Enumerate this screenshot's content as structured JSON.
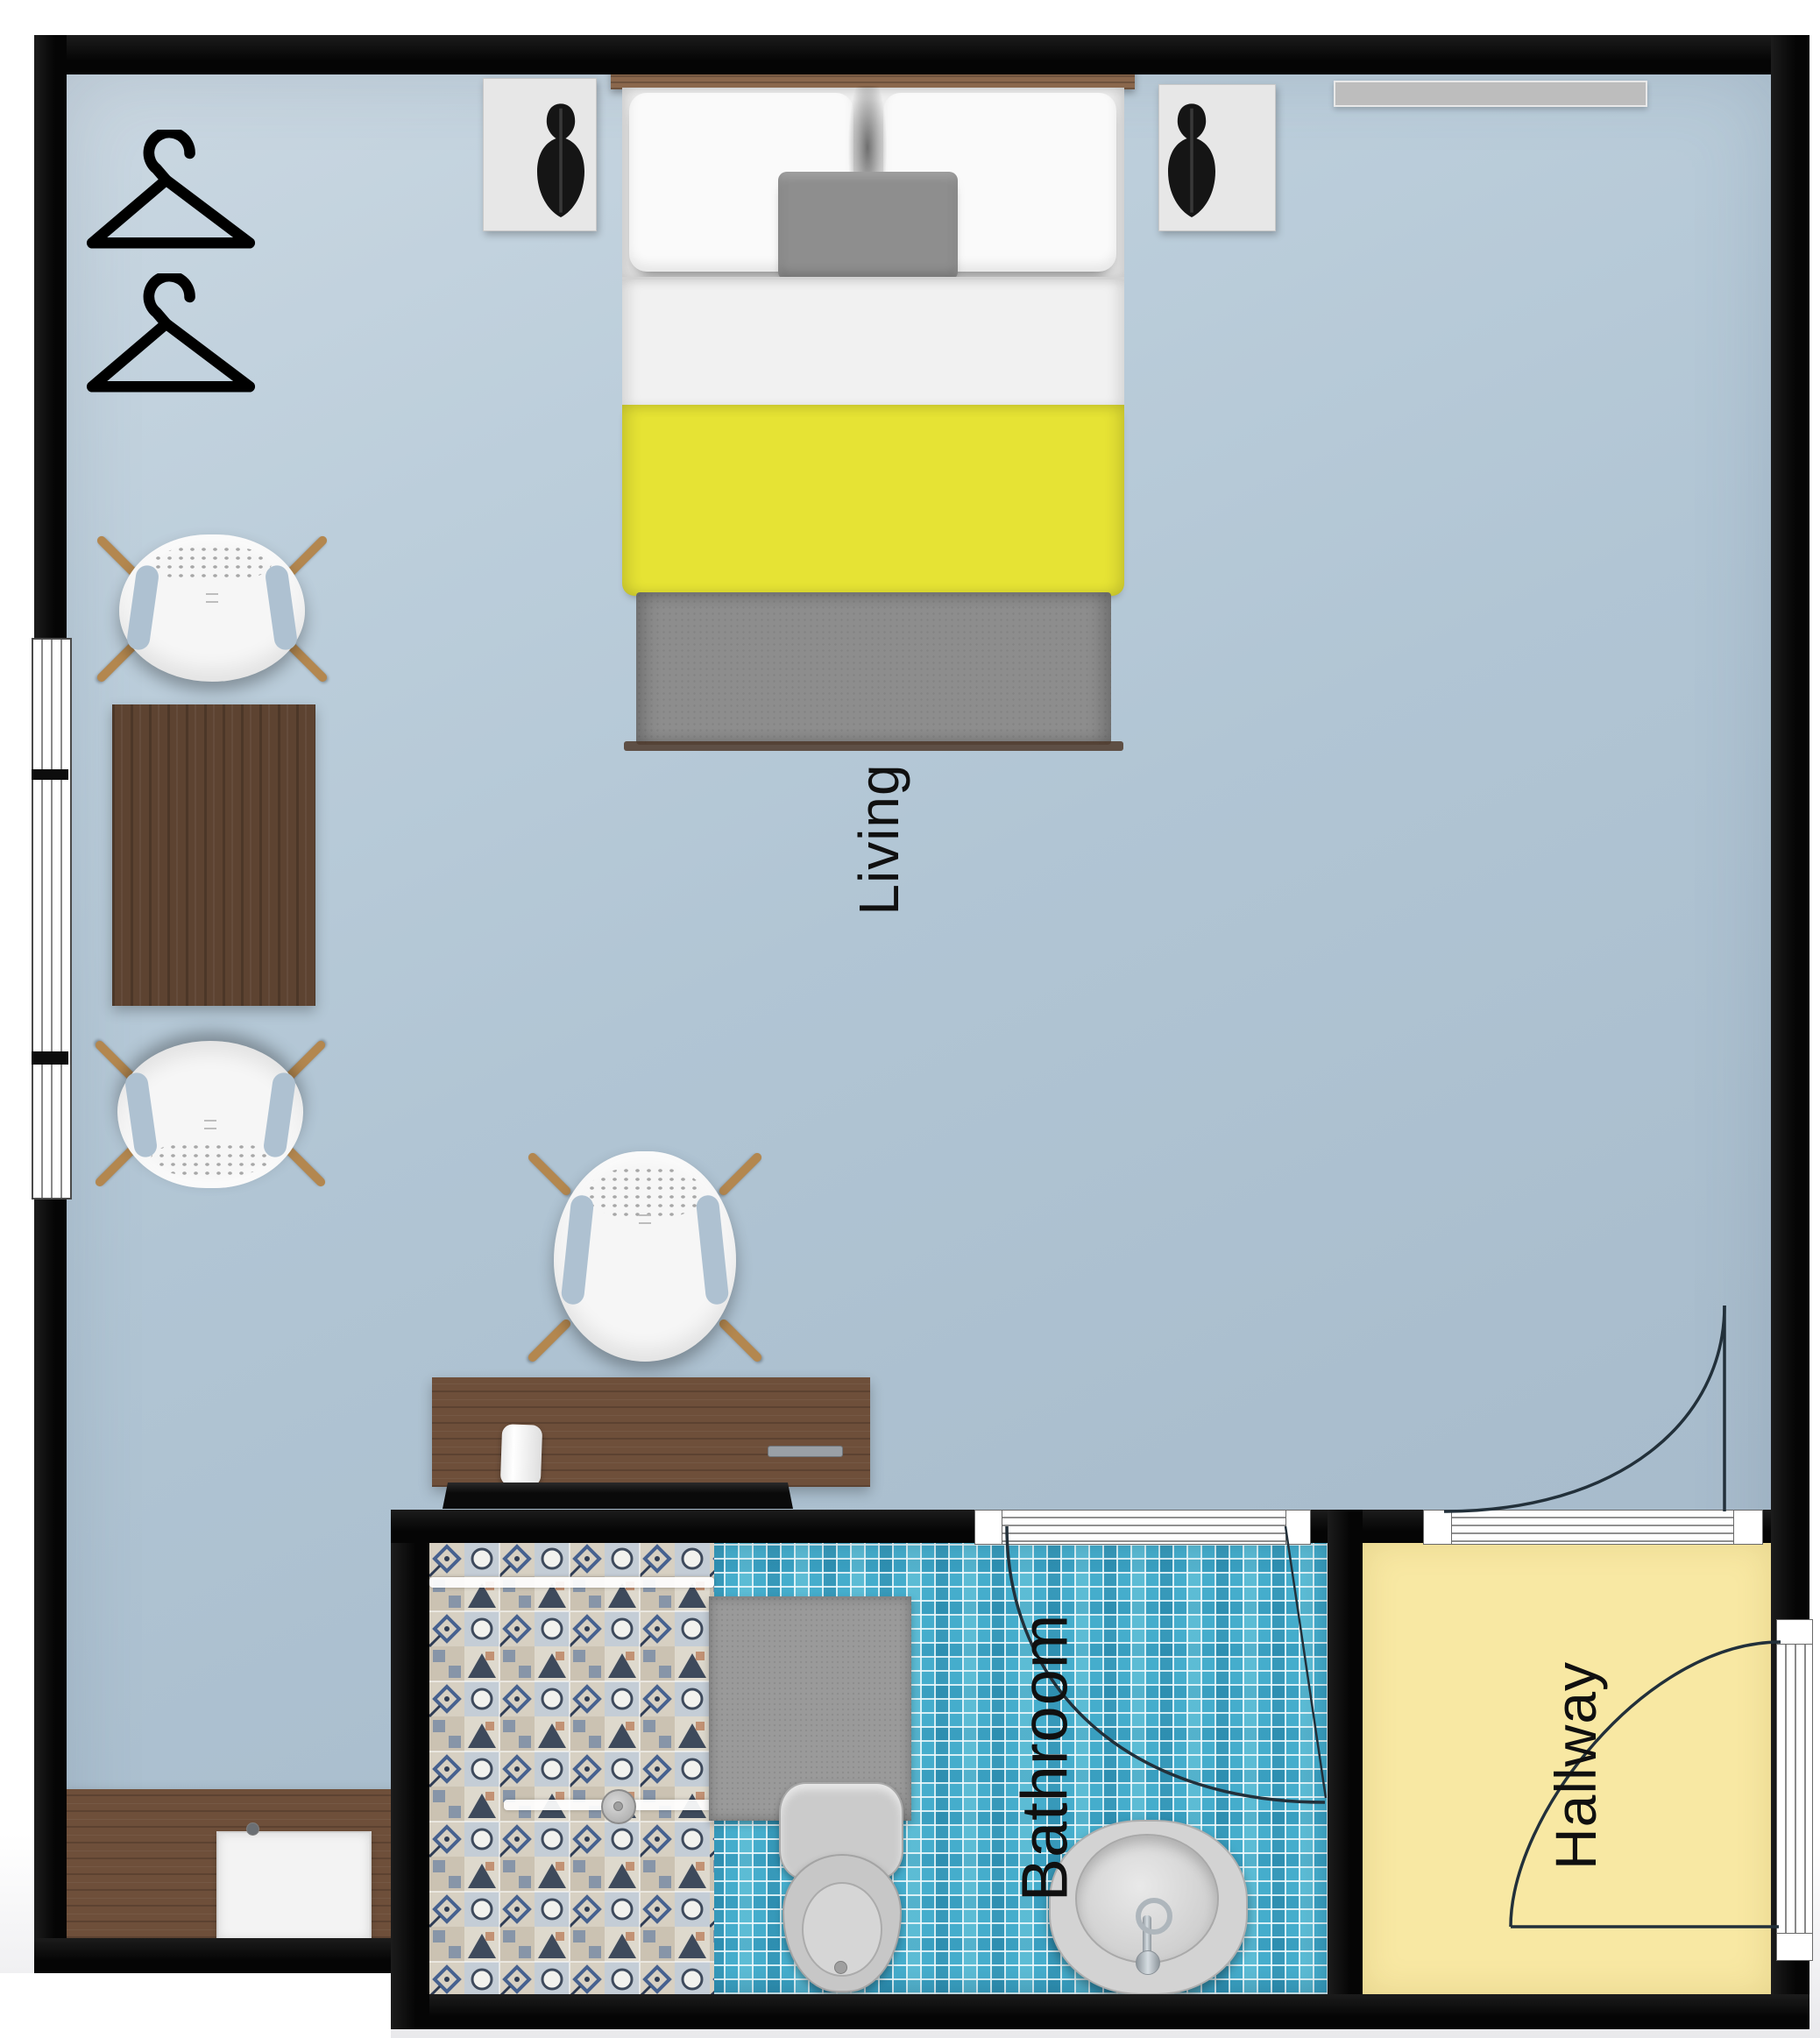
{
  "plan": {
    "type": "apartment-floorplan",
    "rooms": [
      {
        "name": "living",
        "label": "Living"
      },
      {
        "name": "bathroom",
        "label": "Bathroom"
      },
      {
        "name": "hallway",
        "label": "Hallway"
      }
    ],
    "furniture": [
      "double-bed",
      "pillows",
      "gray-accent-pillow",
      "yellow-bed-runner",
      "gray-blanket",
      "nightstand-left",
      "nightstand-right",
      "table-lamp-left",
      "table-lamp-right",
      "coat-hanger-1",
      "coat-hanger-2",
      "wall-shelf",
      "armchair-top-left",
      "armchair-mid-left",
      "armchair-center",
      "side-table",
      "desk",
      "rolled-towel",
      "drawer-handle",
      "tv",
      "vanity-counter",
      "vanity-sink",
      "faucet-dot",
      "shower",
      "shower-glass",
      "shower-head",
      "bath-mat",
      "toilet",
      "washbasin",
      "basin-faucet"
    ],
    "doors": [
      "bathroom-door",
      "living-hallway-door",
      "entrance-door"
    ],
    "windows": [
      "left-wall-window-1",
      "left-wall-window-2",
      "left-wall-window-3",
      "bathroom-doorway-threshold",
      "hallway-doorway-threshold",
      "entrance-doorway"
    ],
    "colors": {
      "wall": "#0a0a0a",
      "floor_living": "#b1c5d4",
      "floor_hallway": "#f8e8a3",
      "floor_bathroom_tile": "#45adcc",
      "shower_tile_base": "#d7d0c2",
      "bed_accent_yellow": "#e6e334",
      "blanket_gray": "#8d8d8d",
      "wood_dark": "#5d4331",
      "wood_mid": "#6e4f3a",
      "chair_leg_wood": "#b3874f",
      "window_white": "#ffffff"
    }
  }
}
